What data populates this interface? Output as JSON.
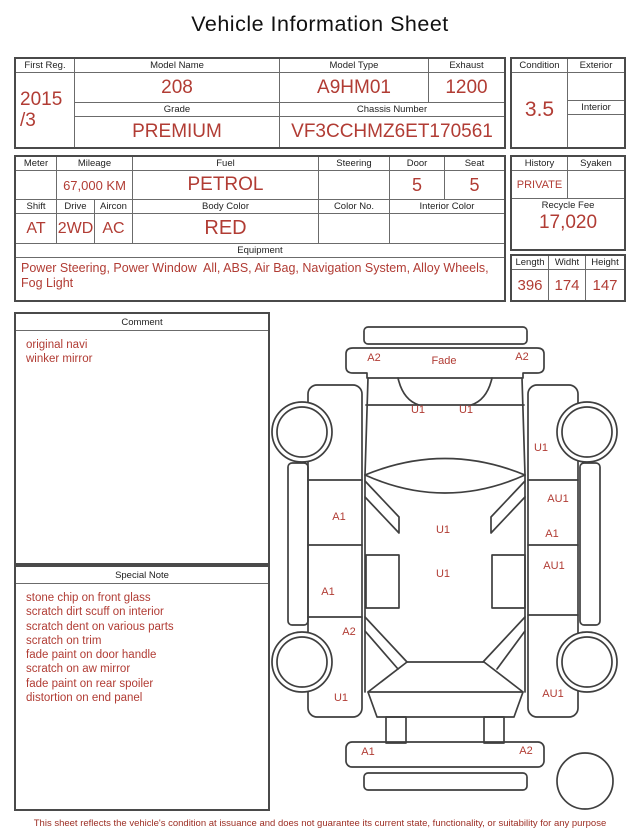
{
  "colors": {
    "accent": "#b13c34",
    "line": "#3f3f3f",
    "footer": "#9c2d23"
  },
  "title": "Vehicle Information Sheet",
  "info": {
    "first_reg": {
      "label": "First Reg.",
      "line1": "2015",
      "line2": "/3"
    },
    "model_name": {
      "label": "Model Name",
      "value": "208"
    },
    "model_type": {
      "label": "Model Type",
      "value": "A9HM01"
    },
    "exhaust": {
      "label": "Exhaust",
      "value": "1200"
    },
    "grade": {
      "label": "Grade",
      "value": "PREMIUM"
    },
    "chassis_number": {
      "label": "Chassis Number",
      "value": "VF3CCHMZ6ET170561"
    },
    "condition": {
      "label": "Condition",
      "value": "3.5"
    },
    "exterior": {
      "label": "Exterior",
      "value": ""
    },
    "interior": {
      "label": "Interior",
      "value": ""
    }
  },
  "details": {
    "meter": {
      "label": "Meter",
      "value": ""
    },
    "mileage": {
      "label": "Mileage",
      "value": "67,000 KM"
    },
    "fuel": {
      "label": "Fuel",
      "value": "PETROL"
    },
    "steering": {
      "label": "Steering",
      "value": ""
    },
    "door": {
      "label": "Door",
      "value": "5"
    },
    "seat": {
      "label": "Seat",
      "value": "5"
    },
    "shift": {
      "label": "Shift",
      "value": "AT"
    },
    "drive": {
      "label": "Drive",
      "value": "2WD"
    },
    "aircon": {
      "label": "Aircon",
      "value": "AC"
    },
    "body_color": {
      "label": "Body Color",
      "value": "RED"
    },
    "color_no": {
      "label": "Color No.",
      "value": ""
    },
    "interior_color": {
      "label": "Interior Color",
      "value": ""
    },
    "equipment": {
      "label": "Equipment",
      "value": "Power Steering, Power Window  All, ABS, Air Bag, Navigation System, Alloy Wheels, Fog Light"
    }
  },
  "right_panel": {
    "history": {
      "label": "History",
      "value": "PRIVATE"
    },
    "syaken": {
      "label": "Syaken",
      "value": ""
    },
    "recycle_fee": {
      "label": "Recycle Fee",
      "value": "17,020"
    },
    "length": {
      "label": "Length",
      "value": "396"
    },
    "width": {
      "label": "Widht",
      "value": "174"
    },
    "height": {
      "label": "Height",
      "value": "147"
    }
  },
  "comment": {
    "label": "Comment",
    "lines": [
      "original navi",
      "winker mirror"
    ]
  },
  "special_note": {
    "label": "Special Note",
    "lines": [
      "stone chip on front glass",
      "scratch dirt scuff on interior",
      "scratch dent on various parts",
      "scratch on trim",
      "fade paint on door handle",
      "scratch on aw mirror",
      "fade paint on rear spoiler",
      "distortion on end panel"
    ]
  },
  "diagram": {
    "labels": [
      {
        "text": "A2",
        "x": 104,
        "y": 46
      },
      {
        "text": "Fade",
        "x": 174,
        "y": 49
      },
      {
        "text": "A2",
        "x": 252,
        "y": 45
      },
      {
        "text": "U1",
        "x": 148,
        "y": 98
      },
      {
        "text": "U1",
        "x": 196,
        "y": 98
      },
      {
        "text": "U1",
        "x": 271,
        "y": 136
      },
      {
        "text": "A1",
        "x": 69,
        "y": 205
      },
      {
        "text": "AU1",
        "x": 288,
        "y": 187
      },
      {
        "text": "U1",
        "x": 173,
        "y": 218
      },
      {
        "text": "A1",
        "x": 282,
        "y": 222
      },
      {
        "text": "AU1",
        "x": 284,
        "y": 254
      },
      {
        "text": "U1",
        "x": 173,
        "y": 262
      },
      {
        "text": "A1",
        "x": 58,
        "y": 280
      },
      {
        "text": "A2",
        "x": 79,
        "y": 320
      },
      {
        "text": "U1",
        "x": 71,
        "y": 386
      },
      {
        "text": "AU1",
        "x": 283,
        "y": 382
      },
      {
        "text": "A1",
        "x": 98,
        "y": 440
      },
      {
        "text": "A2",
        "x": 256,
        "y": 439
      }
    ]
  },
  "footer": "This sheet reflects the vehicle's condition at issuance and does not guarantee its current state, functionality, or suitability for any purpose"
}
